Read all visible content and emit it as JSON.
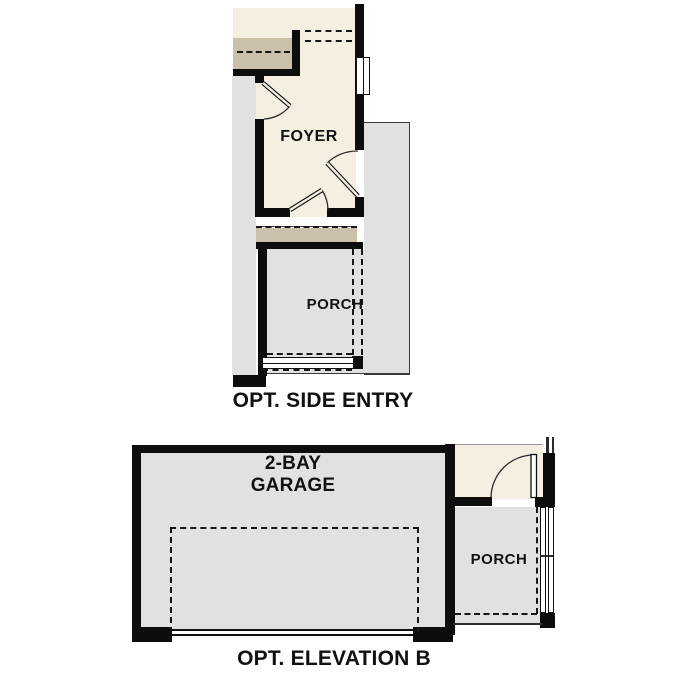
{
  "side_entry": {
    "title": "OPT. SIDE ENTRY",
    "foyer_label": "FOYER",
    "porch_label": "PORCH"
  },
  "elevation_b": {
    "title": "OPT. ELEVATION B",
    "garage_label_line1": "2-BAY",
    "garage_label_line2": "GARAGE",
    "porch_label": "PORCH"
  },
  "colors": {
    "wall_black": "#0d0d0d",
    "floor_cream": "#f5efe2",
    "stoop_tan": "#cbc0a9",
    "concrete_gray": "#e1e1df",
    "background_white": "#ffffff"
  }
}
